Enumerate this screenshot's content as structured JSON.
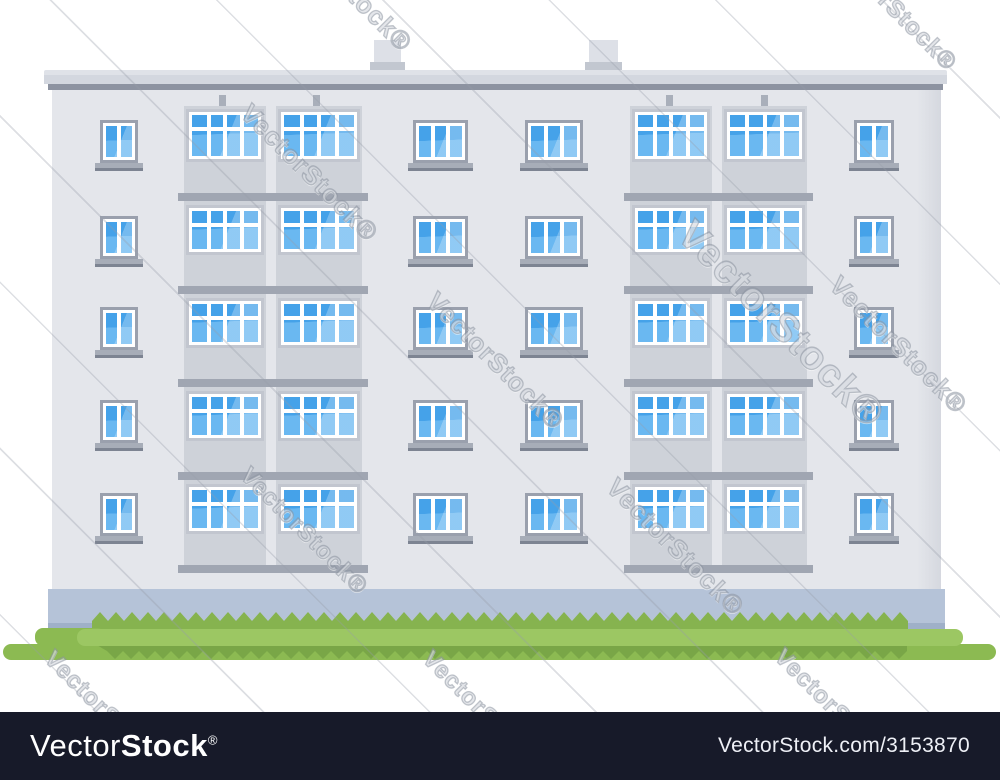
{
  "scene": {
    "background": "#ffffff",
    "subject": "five-story panel apartment building with balconies and lawn, flat vector style"
  },
  "watermark": {
    "text": "VectorStock®",
    "instances": [
      {
        "x": 290,
        "y": -92,
        "size": 26
      },
      {
        "x": 843,
        "y": -62,
        "size": 24
      },
      {
        "x": 256,
        "y": 98,
        "size": 26
      },
      {
        "x": 700,
        "y": 212,
        "size": 40
      },
      {
        "x": 442,
        "y": 286,
        "size": 26
      },
      {
        "x": 845,
        "y": 270,
        "size": 26
      },
      {
        "x": 254,
        "y": 462,
        "size": 24
      },
      {
        "x": 622,
        "y": 472,
        "size": 26
      },
      {
        "x": 58,
        "y": 645,
        "size": 24
      },
      {
        "x": 436,
        "y": 645,
        "size": 24
      },
      {
        "x": 788,
        "y": 643,
        "size": 24
      }
    ]
  },
  "building": {
    "floors": 5,
    "colors": {
      "roof": "#d3d7df",
      "roofEdge": "#8d93a1",
      "chimney": "#dde0e7",
      "chimneyBase": "#c2c7d0",
      "wall": "#e4e6eb",
      "panel": "#ced2d9",
      "slab": "#a0a6b2",
      "frameReg": "#9aa0ad",
      "frameBal": "#c2c6cf",
      "sill": "#a7adb8",
      "sillDark": "#7d8492",
      "glassTop": "#45a2e9",
      "glassBottom": "#6ab8f1",
      "vent": "#a9afba",
      "plinth": "#b5c3d8",
      "plinthDark": "#9fb0c8"
    },
    "layout": {
      "roof": {
        "x": 44,
        "y": 70,
        "w": 903,
        "h": 14
      },
      "roofEdge": {
        "x": 48,
        "y": 84,
        "w": 895,
        "h": 6
      },
      "chimneys": [
        {
          "x": 374,
          "y": 40,
          "w": 27,
          "h": 22,
          "bx": 370,
          "bw": 35,
          "bh": 9
        },
        {
          "x": 589,
          "y": 40,
          "w": 29,
          "h": 22,
          "bx": 585,
          "bw": 37,
          "bh": 9
        }
      ],
      "wall": {
        "x": 52,
        "y": 90,
        "w": 889,
        "h": 499
      },
      "plinth": {
        "x": 48,
        "y": 589,
        "w": 897,
        "h": 41
      },
      "vents": [
        219,
        313,
        666,
        761
      ],
      "rows": {
        "reg": [
          120,
          216,
          307,
          400,
          493
        ],
        "regH": 43,
        "bal": [
          109,
          205,
          298,
          391,
          484
        ],
        "balH": [
          53,
          50,
          50,
          50,
          50
        ],
        "slabs": [
          193,
          286,
          379,
          472,
          565
        ],
        "slabH": 8,
        "panelTop": 106,
        "panelBottom": 573
      },
      "singleCols": [
        {
          "x": 100,
          "w": 38
        },
        {
          "x": 854,
          "w": 40
        }
      ],
      "tripleCols": [
        {
          "x": 413,
          "w": 55
        },
        {
          "x": 525,
          "w": 58
        }
      ],
      "balconySections": [
        {
          "x": 184,
          "w": 82
        },
        {
          "x": 276,
          "w": 86
        },
        {
          "x": 630,
          "w": 82
        },
        {
          "x": 722,
          "w": 85
        }
      ],
      "balconyTopRow": 12
    }
  },
  "grass": {
    "colors": {
      "grassDark": "#86b34f",
      "grassMid": "#8cba52",
      "grassLight": "#9cc763",
      "grassTeeth": "#79a647"
    },
    "layout": {
      "backZigzag": {
        "x": 92,
        "y": 612,
        "w": 816,
        "h": 36,
        "toothW": 16,
        "toothH": 9
      },
      "midBase": {
        "x": 3,
        "y": 644,
        "w": 993,
        "h": 16
      },
      "leftStep": {
        "x": 35,
        "y": 628,
        "w": 70,
        "h": 18
      },
      "teethDown": {
        "x": 95,
        "y": 644,
        "w": 812,
        "h": 15,
        "toothW": 16,
        "toothH": 8
      },
      "lightBand": {
        "x": 77,
        "y": 629,
        "w": 886,
        "h": 17
      }
    }
  },
  "footer": {
    "background": "#171a29",
    "logo_light": "Vector",
    "logo_bold": "Stock",
    "logo_reg": "®",
    "site": "VectorStock.com/3153870"
  }
}
